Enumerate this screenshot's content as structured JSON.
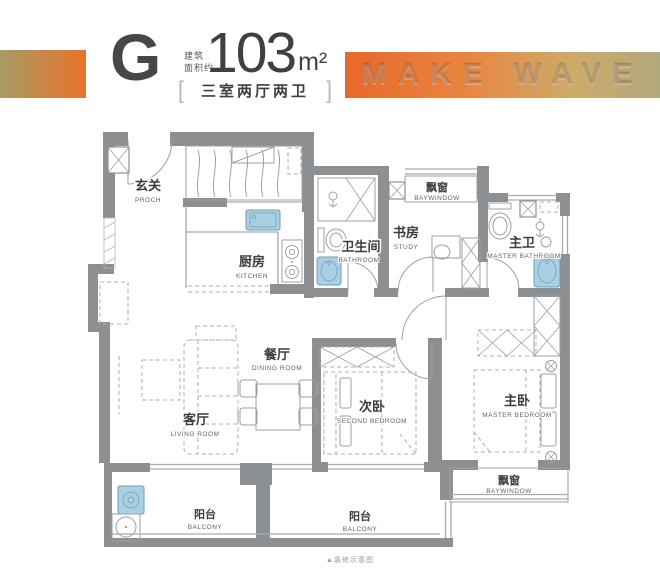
{
  "header": {
    "unit_letter": "G",
    "area_label_line1": "建筑",
    "area_label_line2": "面积约",
    "area_value": "103",
    "area_unit": "m²",
    "bracket_left": "[",
    "bracket_right": "]",
    "layout_description": "三室两厅两卫",
    "banner_text": "MAKE WAVE"
  },
  "rooms": {
    "entrance": {
      "zh": "玄关",
      "en": "PROCH"
    },
    "kitchen": {
      "zh": "厨房",
      "en": "KITCHEN"
    },
    "bathroom": {
      "zh": "卫生间",
      "en": "BATHROOM"
    },
    "study": {
      "zh": "书房",
      "en": "STUDY"
    },
    "bay_window_top": {
      "zh": "飘窗",
      "en": "BAYWINDOW"
    },
    "master_bathroom": {
      "zh": "主卫",
      "en": "MASTER BATHROOM"
    },
    "dining": {
      "zh": "餐厅",
      "en": "DINING ROOM"
    },
    "living": {
      "zh": "客厅",
      "en": "LIVING ROOM"
    },
    "second_bedroom": {
      "zh": "次卧",
      "en": "SECOND BEDROOM"
    },
    "master_bedroom": {
      "zh": "主卧",
      "en": "MASTER BEDROOM"
    },
    "bay_window_bottom": {
      "zh": "飘窗",
      "en": "BAYWINDOW"
    },
    "balcony_left": {
      "zh": "阳台",
      "en": "BALCONY"
    },
    "balcony_right": {
      "zh": "阳台",
      "en": "BALCONY"
    }
  },
  "footer": {
    "note": "▲装修示意图"
  },
  "colors": {
    "accent_orange": "#ea732c",
    "accent_olive": "#a69b63",
    "banner_orange": "#e8682a",
    "banner_olive": "#b2a87d",
    "wall_gray": "#8d9093",
    "fixture_blue": "#aacfe2"
  }
}
